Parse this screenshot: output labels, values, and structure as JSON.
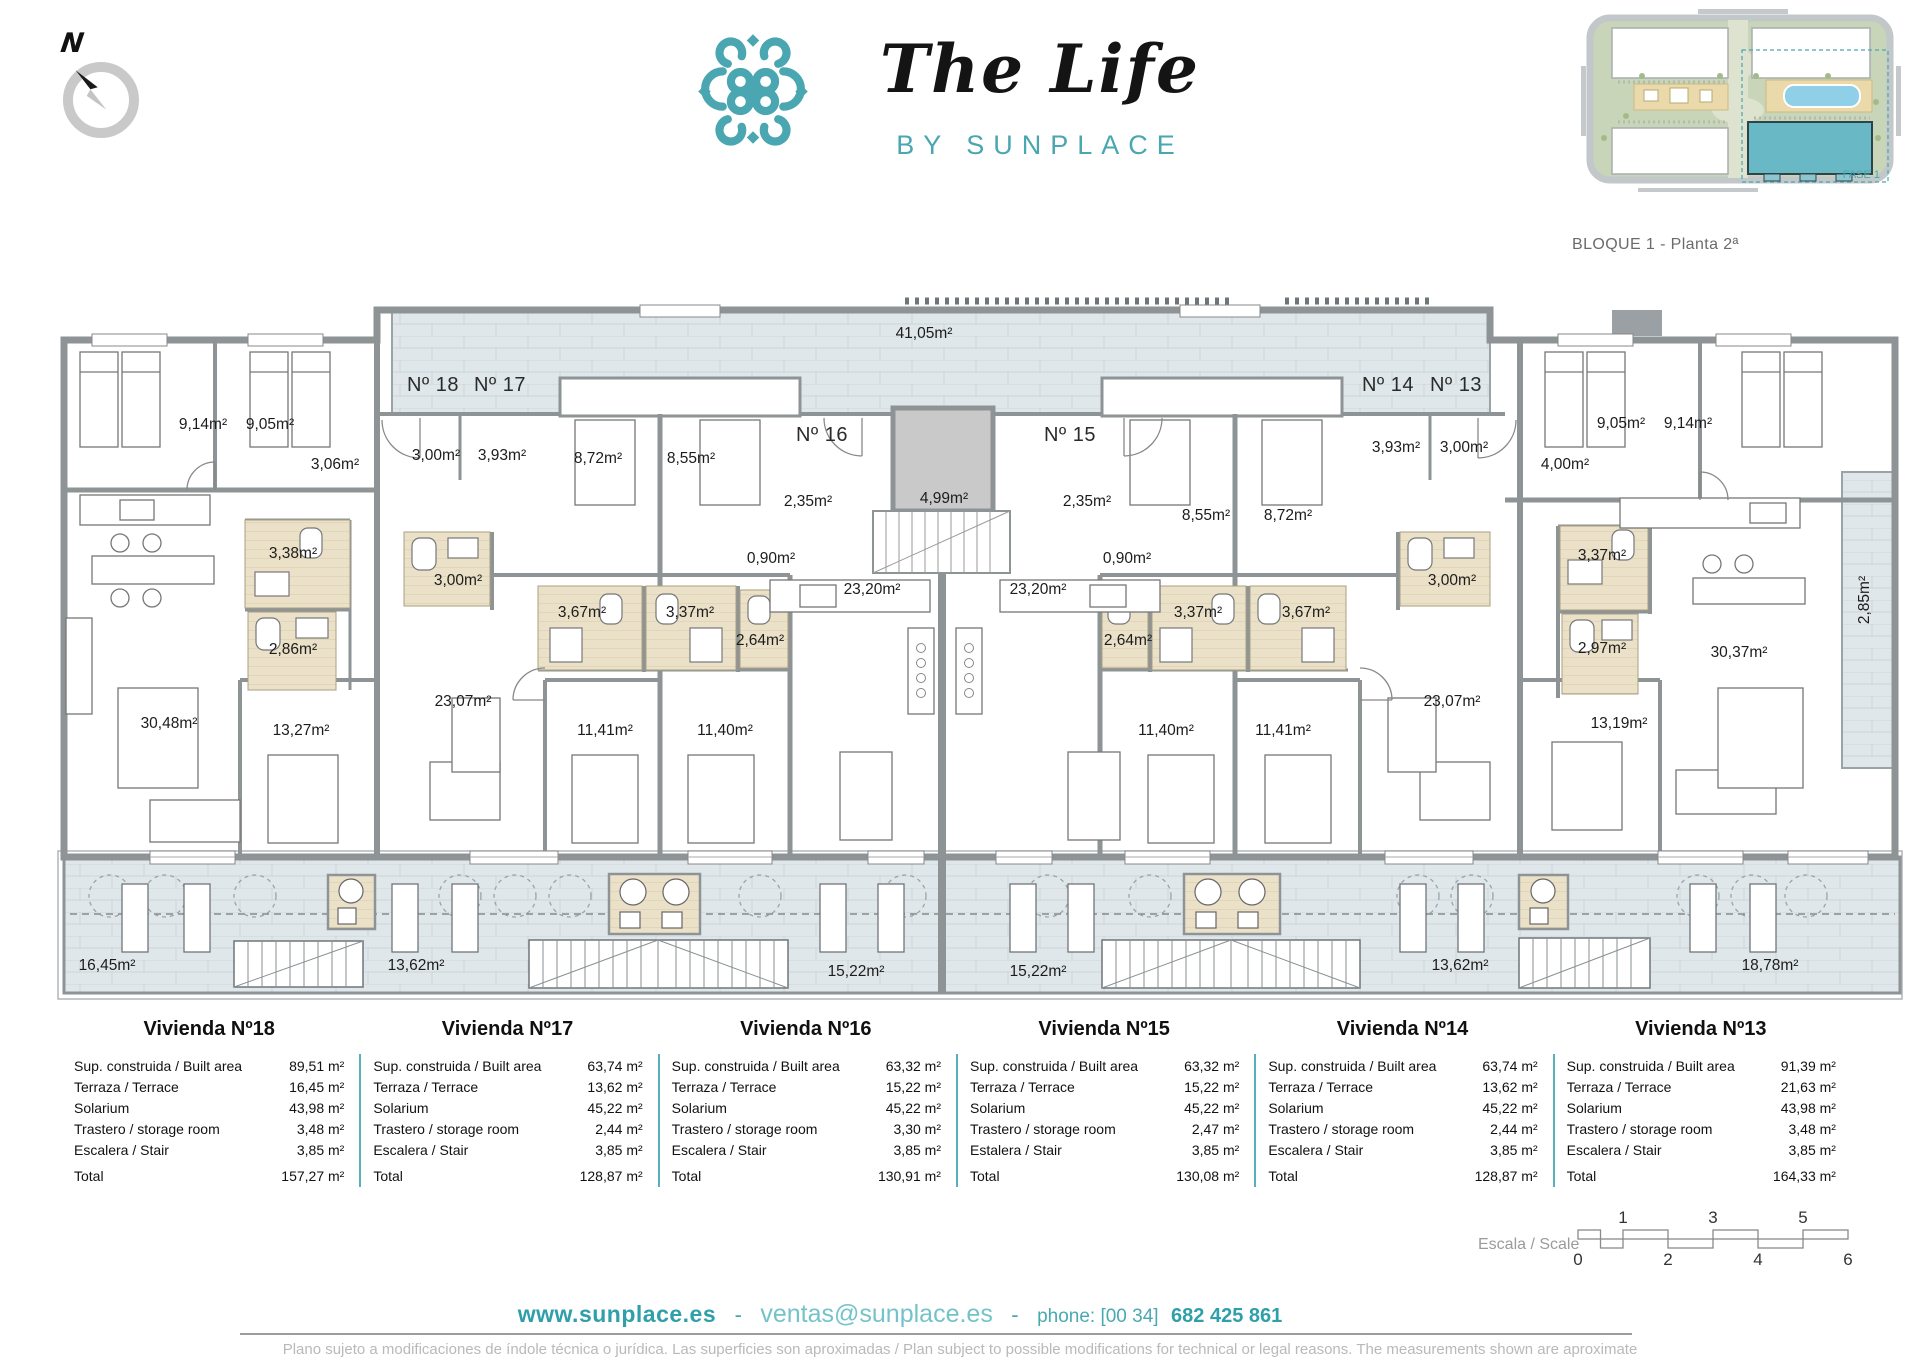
{
  "compass": {
    "label": "N"
  },
  "brand": {
    "title": "The Life",
    "subtitle": "BY SUNPLACE"
  },
  "inset": {
    "caption": "BLOQUE 1 - Planta 2ª",
    "fase_label": "FASE 1"
  },
  "colors": {
    "teal": "#4aa6b0",
    "wall_gray": "#8e9396",
    "terrace": "#e0e7ea",
    "bath": "#ebe1c9"
  },
  "plan": {
    "labels": [
      {
        "t": "Nº 18",
        "x": 433,
        "y": 391,
        "big": true
      },
      {
        "t": "Nº 17",
        "x": 500,
        "y": 391,
        "big": true
      },
      {
        "t": "Nº 16",
        "x": 822,
        "y": 441,
        "big": true
      },
      {
        "t": "Nº 15",
        "x": 1070,
        "y": 441,
        "big": true
      },
      {
        "t": "Nº 14",
        "x": 1388,
        "y": 391,
        "big": true
      },
      {
        "t": "Nº 13",
        "x": 1456,
        "y": 391,
        "big": true
      },
      {
        "t": "41,05m²",
        "x": 924,
        "y": 338
      },
      {
        "t": "9,14m²",
        "x": 203,
        "y": 429
      },
      {
        "t": "9,05m²",
        "x": 270,
        "y": 429
      },
      {
        "t": "3,06m²",
        "x": 335,
        "y": 469
      },
      {
        "t": "3,00m²",
        "x": 436,
        "y": 460
      },
      {
        "t": "3,93m²",
        "x": 502,
        "y": 460
      },
      {
        "t": "8,72m²",
        "x": 598,
        "y": 463
      },
      {
        "t": "8,55m²",
        "x": 691,
        "y": 463
      },
      {
        "t": "2,35m²",
        "x": 808,
        "y": 506
      },
      {
        "t": "4,99m²",
        "x": 944,
        "y": 503
      },
      {
        "t": "2,35m²",
        "x": 1087,
        "y": 506
      },
      {
        "t": "8,55m²",
        "x": 1206,
        "y": 520
      },
      {
        "t": "8,72m²",
        "x": 1288,
        "y": 520
      },
      {
        "t": "3,93m²",
        "x": 1396,
        "y": 452
      },
      {
        "t": "3,00m²",
        "x": 1464,
        "y": 452
      },
      {
        "t": "4,00m²",
        "x": 1565,
        "y": 469
      },
      {
        "t": "9,05m²",
        "x": 1621,
        "y": 428
      },
      {
        "t": "9,14m²",
        "x": 1688,
        "y": 428
      },
      {
        "t": "3,38m²",
        "x": 293,
        "y": 558
      },
      {
        "t": "3,00m²",
        "x": 458,
        "y": 585
      },
      {
        "t": "0,90m²",
        "x": 771,
        "y": 563
      },
      {
        "t": "0,90m²",
        "x": 1127,
        "y": 563
      },
      {
        "t": "3,00m²",
        "x": 1452,
        "y": 585
      },
      {
        "t": "3,37m²",
        "x": 1602,
        "y": 560
      },
      {
        "t": "2,86m²",
        "x": 293,
        "y": 654
      },
      {
        "t": "3,67m²",
        "x": 582,
        "y": 617
      },
      {
        "t": "3,37m²",
        "x": 690,
        "y": 617
      },
      {
        "t": "2,64m²",
        "x": 760,
        "y": 645
      },
      {
        "t": "2,64m²",
        "x": 1128,
        "y": 645
      },
      {
        "t": "3,37m²",
        "x": 1198,
        "y": 617
      },
      {
        "t": "3,67m²",
        "x": 1306,
        "y": 617
      },
      {
        "t": "2,97m²",
        "x": 1602,
        "y": 653
      },
      {
        "t": "23,20m²",
        "x": 872,
        "y": 594
      },
      {
        "t": "23,20m²",
        "x": 1038,
        "y": 594
      },
      {
        "t": "30,37m²",
        "x": 1739,
        "y": 657
      },
      {
        "t": "2,85m²",
        "x": 1869,
        "y": 600,
        "r": -90
      },
      {
        "t": "23,07m²",
        "x": 463,
        "y": 706
      },
      {
        "t": "23,07m²",
        "x": 1452,
        "y": 706
      },
      {
        "t": "30,48m²",
        "x": 169,
        "y": 728
      },
      {
        "t": "13,27m²",
        "x": 301,
        "y": 735
      },
      {
        "t": "11,41m²",
        "x": 605,
        "y": 735
      },
      {
        "t": "11,40m²",
        "x": 725,
        "y": 735
      },
      {
        "t": "11,40m²",
        "x": 1166,
        "y": 735
      },
      {
        "t": "11,41m²",
        "x": 1283,
        "y": 735
      },
      {
        "t": "13,19m²",
        "x": 1619,
        "y": 728
      },
      {
        "t": "16,45m²",
        "x": 107,
        "y": 970
      },
      {
        "t": "13,62m²",
        "x": 416,
        "y": 970
      },
      {
        "t": "15,22m²",
        "x": 856,
        "y": 976
      },
      {
        "t": "15,22m²",
        "x": 1038,
        "y": 976
      },
      {
        "t": "13,62m²",
        "x": 1460,
        "y": 970
      },
      {
        "t": "18,78m²",
        "x": 1770,
        "y": 970
      }
    ]
  },
  "table": {
    "units": [
      {
        "title": "Vivienda Nº18",
        "rows": [
          [
            "Sup. construida / Built area",
            "89,51 m²"
          ],
          [
            "Terraza / Terrace",
            "16,45 m²"
          ],
          [
            "Solarium",
            "43,98 m²"
          ],
          [
            "Trastero / storage room",
            "3,48 m²"
          ],
          [
            "Escalera / Stair",
            "3,85 m²"
          ],
          [
            "Total",
            "157,27 m²"
          ]
        ]
      },
      {
        "title": "Vivienda Nº17",
        "rows": [
          [
            "Sup. construida / Built area",
            "63,74 m²"
          ],
          [
            "Terraza / Terrace",
            "13,62 m²"
          ],
          [
            "Solarium",
            "45,22 m²"
          ],
          [
            "Trastero / storage room",
            "2,44 m²"
          ],
          [
            "Escalera / Stair",
            "3,85 m²"
          ],
          [
            "Total",
            "128,87 m²"
          ]
        ]
      },
      {
        "title": "Vivienda Nº16",
        "rows": [
          [
            "Sup. construida / Built area",
            "63,32 m²"
          ],
          [
            "Terraza / Terrace",
            "15,22 m²"
          ],
          [
            "Solarium",
            "45,22 m²"
          ],
          [
            "Trastero / storage room",
            "3,30 m²"
          ],
          [
            "Escalera / Stair",
            "3,85 m²"
          ],
          [
            "Total",
            "130,91 m²"
          ]
        ]
      },
      {
        "title": "Vivienda Nº15",
        "rows": [
          [
            "Sup. construida / Built area",
            "63,32 m²"
          ],
          [
            "Terraza / Terrace",
            "15,22 m²"
          ],
          [
            "Solarium",
            "45,22 m²"
          ],
          [
            "Trastero / storage room",
            "2,47 m²"
          ],
          [
            "Estalera / Stair",
            "3,85 m²"
          ],
          [
            "Total",
            "130,08 m²"
          ]
        ]
      },
      {
        "title": "Vivienda Nº14",
        "rows": [
          [
            "Sup. construida / Built area",
            "63,74 m²"
          ],
          [
            "Terraza / Terrace",
            "13,62 m²"
          ],
          [
            "Solarium",
            "45,22 m²"
          ],
          [
            "Trastero / storage room",
            "2,44 m²"
          ],
          [
            "Escalera / Stair",
            "3,85 m²"
          ],
          [
            "Total",
            "128,87 m²"
          ]
        ]
      },
      {
        "title": "Vivienda Nº13",
        "rows": [
          [
            "Sup. construida / Built area",
            "91,39 m²"
          ],
          [
            "Terraza / Terrace",
            "21,63 m²"
          ],
          [
            "Solarium",
            "43,98 m²"
          ],
          [
            "Trastero / storage room",
            "3,48 m²"
          ],
          [
            "Escalera / Stair",
            "3,85 m²"
          ],
          [
            "Total",
            "164,33 m²"
          ]
        ]
      }
    ]
  },
  "scale_bar": {
    "label": "Escala / Scale",
    "top_ticks": [
      {
        "t": "1",
        "u": 1
      },
      {
        "t": "3",
        "u": 3
      },
      {
        "t": "5",
        "u": 5
      }
    ],
    "bottom_ticks": [
      {
        "t": "0",
        "u": 0
      },
      {
        "t": "2",
        "u": 2
      },
      {
        "t": "4",
        "u": 4
      },
      {
        "t": "6",
        "u": 6
      }
    ]
  },
  "footer": {
    "website": "www.sunplace.es",
    "separator": "-",
    "email": "ventas@sunplace.es",
    "phone_label": "phone: [00 34]",
    "phone_number": "682 425 861",
    "disclaimer": "Plano sujeto a modificaciones de índole técnica o jurídica. Las superficies son aproximadas / Plan subject to possible modifications for technical or legal reasons. The measurements  shown are aproximate"
  }
}
